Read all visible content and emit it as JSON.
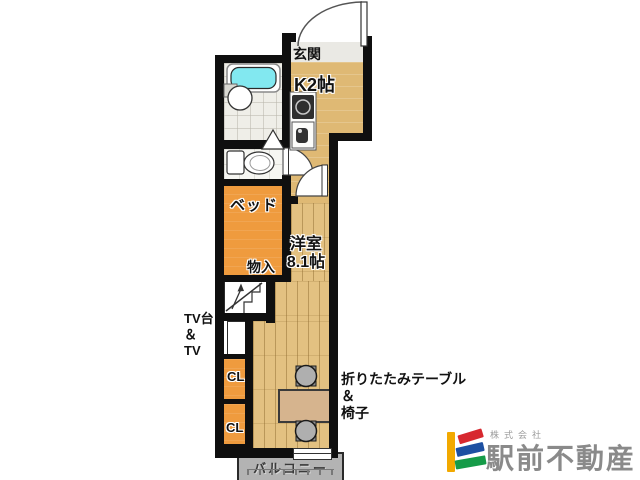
{
  "floor_plan": {
    "labels": {
      "entrance": "玄関",
      "kitchen": "K2帖",
      "bed": "ベッド",
      "storage": "物入",
      "room_name": "洋室",
      "room_size": "8.1帖",
      "tv_line1": "TV台",
      "tv_line2": "＆",
      "tv_line3": "TV",
      "closet_upper": "CL",
      "closet_lower": "CL",
      "furniture_line1": "折りたたみテーブル",
      "furniture_line2": "＆",
      "furniture_line3": "椅子",
      "balcony": "バルコニー"
    },
    "colors": {
      "wall": "#0f0f0f",
      "kitchen_floor": "#dfb974",
      "wood_floor": "#e3c181",
      "furniture_orange": "#ef9b3e",
      "bathtub_cyan": "#82E8F0",
      "balcony_gray": "#b3b3b3",
      "table_tan": "#d6b48e"
    }
  },
  "logo": {
    "company_prefix": "株式会社",
    "company_name": "駅前不動産",
    "mark_colors": {
      "bar": "#F2A900",
      "stripe_top": "#D7282F",
      "stripe_middle": "#1D50A2",
      "stripe_bottom": "#159B48"
    }
  }
}
